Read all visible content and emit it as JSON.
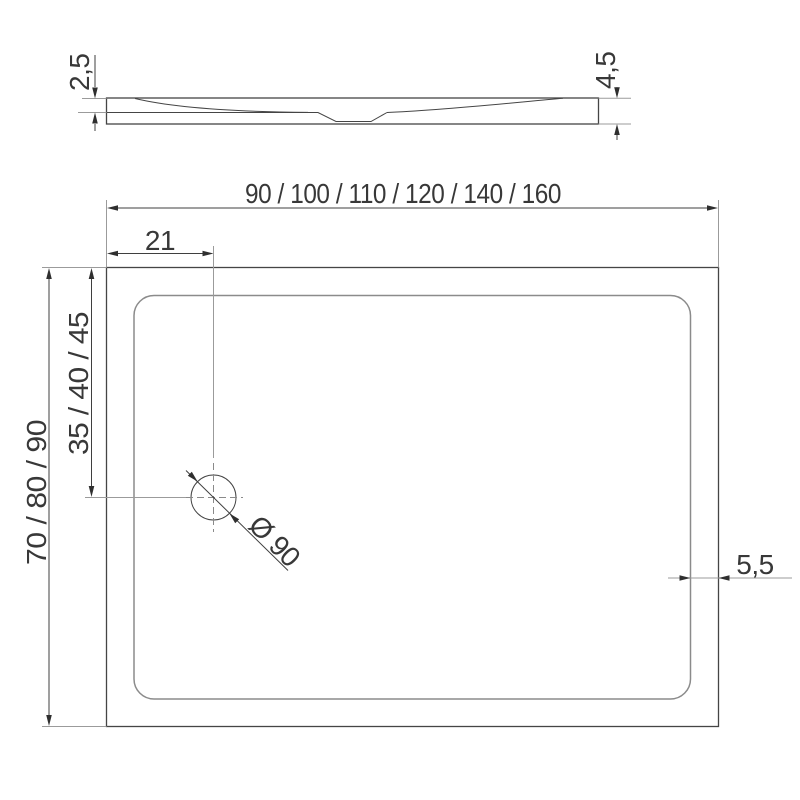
{
  "side_view": {
    "rim_height_label": "2,5",
    "total_height_label": "4,5"
  },
  "top_view": {
    "width_sizes_label": "90 / 100 / 110 / 120 / 140 / 160",
    "drain_offset_from_left_label": "21",
    "drain_offset_from_top_label": "35 / 40 / 45",
    "depth_sizes_label": "70 / 80 / 90",
    "drain_diameter_label": "Ø 90",
    "rim_width_label": "5,5"
  },
  "colors": {
    "background": "#ffffff",
    "geometry_line": "#454545",
    "inner_edge_line": "#8b8b8b",
    "dimension_line": "#3f3f3f",
    "extension_line": "#9b9b9b",
    "centerline": "#8a8a8a",
    "arrow": "#2f2f2f",
    "text": "#383838"
  }
}
